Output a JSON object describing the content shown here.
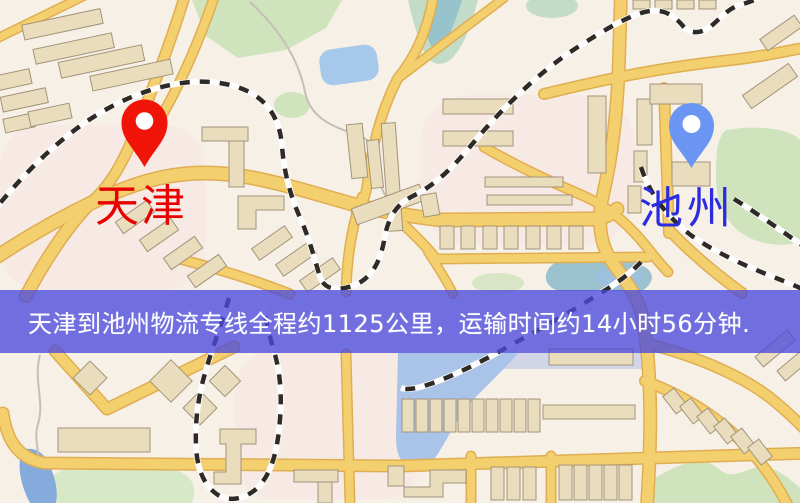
{
  "banner": {
    "text": "天津到池州物流专线全程约1125公里，运输时间约14小时56分钟.",
    "overlay_color": "rgba(76,73,221,0.78)",
    "text_color": "#ffffff"
  },
  "markers": {
    "origin": {
      "name": "天津",
      "pin_color": "#f11408",
      "label_color": "#e80000"
    },
    "destination": {
      "name": "池州",
      "pin_color": "#6a95f3",
      "label_color": "#2b2bdf"
    }
  },
  "palette": {
    "background": "#f7f0e7",
    "road_fill": "#f4cf6e",
    "road_casing": "#e0ae52",
    "railway_dash": "#2e2a26",
    "railway_base": "#fdfdfd",
    "building_fill": "#e9ddbe",
    "building_stroke": "#a3947a",
    "park_green": "#cfe3bd",
    "water_blue": "#a9c4e8"
  }
}
